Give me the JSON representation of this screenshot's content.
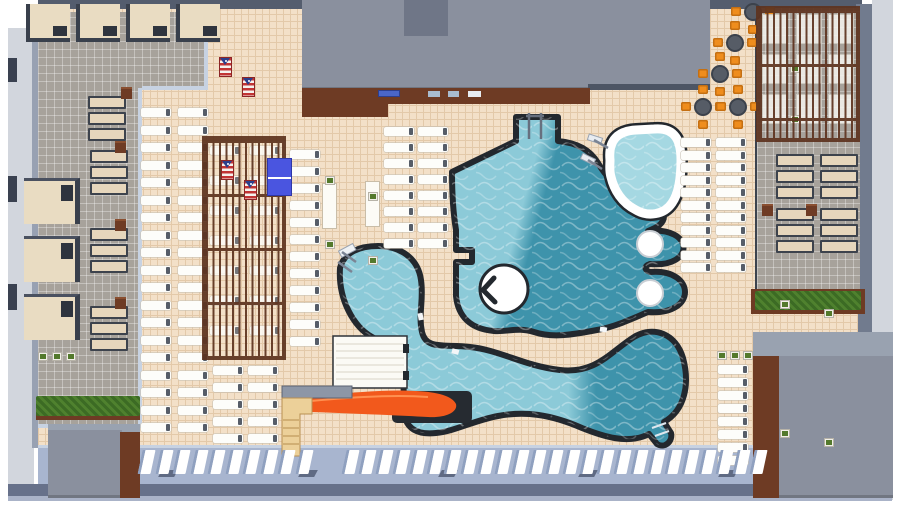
{
  "scene": {
    "type": "3d-top-down-site-plan",
    "subject": "Resort pool deck plan: lagoon pool with island and two round pods, lazy-river pool with end bulbs, spa with white coping, orange water slide with stair tower, white shade structure, cabanas, two wood pergolas, lounger rows, dining tables with orange chairs, cornhole boards, ping-pong table, hedges and service buildings"
  },
  "colors": {
    "deck": "#f3e0c8",
    "deck-line": "#e3c9a9",
    "tile-gray": "#a7a29b",
    "walkway": "#a8b5cf",
    "wall-dark": "#545d6e",
    "wall-mid": "#717b8e",
    "wall-light": "#d2d6dd",
    "curb": "#c7d2e2",
    "pool-outline": "#23282e",
    "water-light": "#8ccad8",
    "water-dark": "#3e93ab",
    "water-spa": "#a5d8e2",
    "coping": "#ffffff",
    "pergola-wood": "#5e3420",
    "wood-trim": "#6e3b24",
    "canopy": "#e9dcc2",
    "daybed": "#e6d6bc",
    "lounger": "#fdfdfa",
    "slide-orange": "#f2591c",
    "stairs-tan": "#ecd099",
    "hedge-green": "#3c6b24",
    "planter-green": "#53792c",
    "table-brown": "#6e3b24",
    "chair-orange": "#ef8d1d",
    "table-top": "#565c66",
    "building-gray": "#8a909e",
    "building-dark": "#6f7687",
    "pingpong-blue": "#4a55e0",
    "flag-red": "#c23434",
    "flag-blue": "#2b3f8c"
  },
  "features": {
    "pools": {
      "count": 3,
      "main_lagoon": {
        "islands": 1,
        "round_side_pods": 2,
        "ladder_bays": 1
      },
      "lazy_river": {
        "end_bulbs": 2,
        "ladders": 1,
        "exit_steps": 1
      },
      "spa": {
        "ladders": 2,
        "coping": "white"
      }
    },
    "water_slide": {
      "count": 1,
      "parts": [
        "stair-tower",
        "platform",
        "orange-flume",
        "splash-channel"
      ]
    },
    "shade_structures_white": 1,
    "cabanas": {
      "top_row": 4,
      "left_column": 3
    },
    "pergolas": {
      "count": 2
    },
    "round_tables": {
      "count": 5,
      "chairs_each": 4
    },
    "cornhole_boards": {
      "count": 4
    },
    "ping_pong_tables": {
      "count": 1
    },
    "hedges": {
      "count": 2
    },
    "buildings": {
      "count": 3
    },
    "lounger_columns": {
      "a": 19,
      "b": 19,
      "c": 12,
      "d": 8,
      "e": 8,
      "f": 11,
      "g": 11,
      "h": 8,
      "i": 5,
      "j": 5,
      "pergola_col": 7,
      "pergola_right_col": 3
    },
    "bottom_row": {
      "segment_a": 10,
      "segment_b": 25
    },
    "daybeds": {
      "group_size": 3,
      "left_groups": 3,
      "top_left_groups": 1,
      "right_clusters": 4,
      "side_tables": 7
    },
    "planters": {
      "row_size": 3,
      "cluster_planters": 4
    },
    "counter_items": 4,
    "walkway_joints": 5
  }
}
